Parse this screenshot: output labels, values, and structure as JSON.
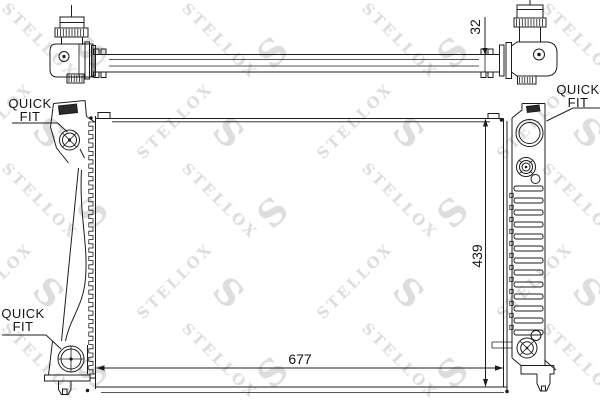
{
  "drawing": {
    "kind": "radiator technical line drawing",
    "brand": "STELLOX"
  },
  "watermark": {
    "text": "STELLOX",
    "letter": "S"
  },
  "labels": {
    "quick": "QUICK",
    "fit": "FIT"
  },
  "dimensions": {
    "pipe": "32",
    "height": "439",
    "width": "677"
  },
  "colors": {
    "line": "#1c1c1c",
    "watermark": "#d2d2d2",
    "background": "#ffffff"
  }
}
